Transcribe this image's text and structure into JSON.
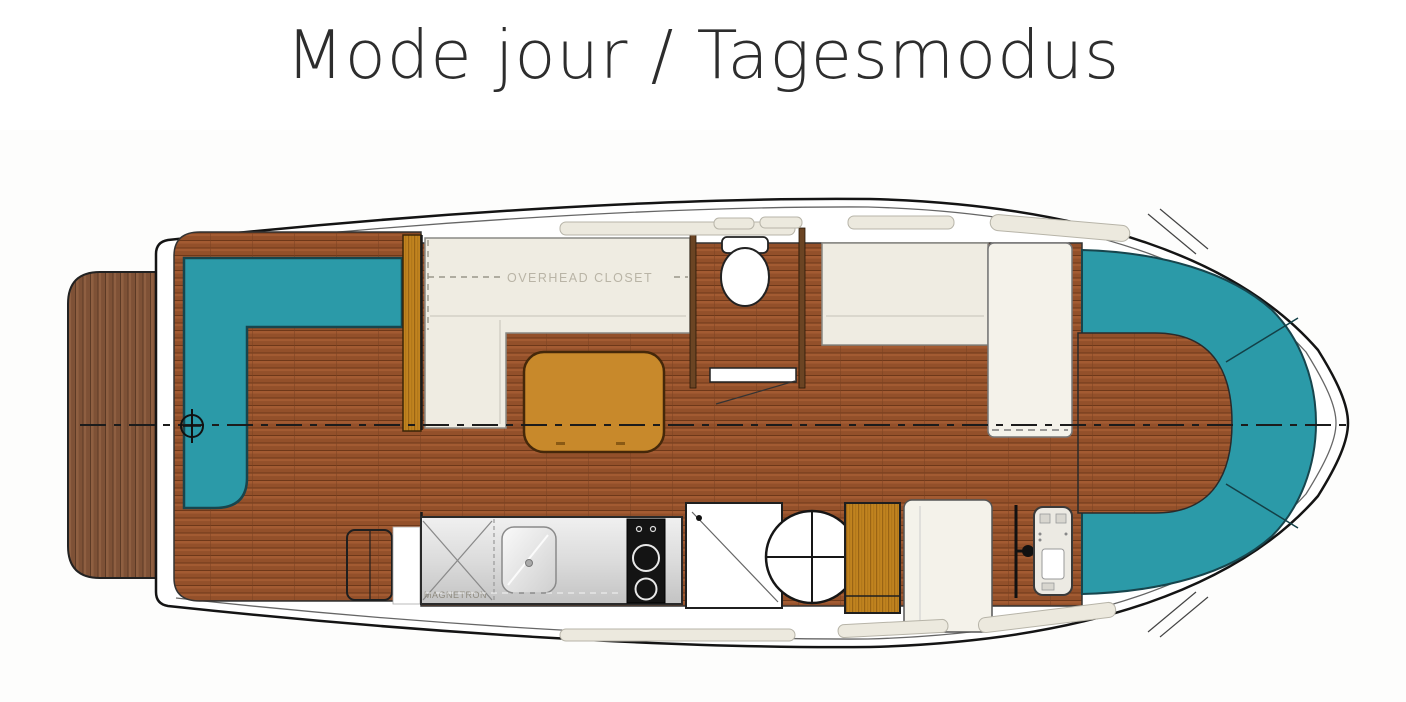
{
  "title": "Mode jour / Tagesmodus",
  "floorplan": {
    "labels": {
      "overhead_closet": "OVERHEAD CLOSET",
      "microwave": "MAGNETRON"
    },
    "colors": {
      "upholstery_teal": "#2B9AA8",
      "deck_wood": "#A35B32",
      "platform_wood": "#8F5F41",
      "gold_wood": "#C1831F",
      "table_wood": "#C8892B",
      "furniture_cream": "#EFECE2",
      "counter_gray": "#D9D9D9",
      "cooktop_black": "#141414",
      "outline_dark": "#1A1A1A"
    }
  }
}
